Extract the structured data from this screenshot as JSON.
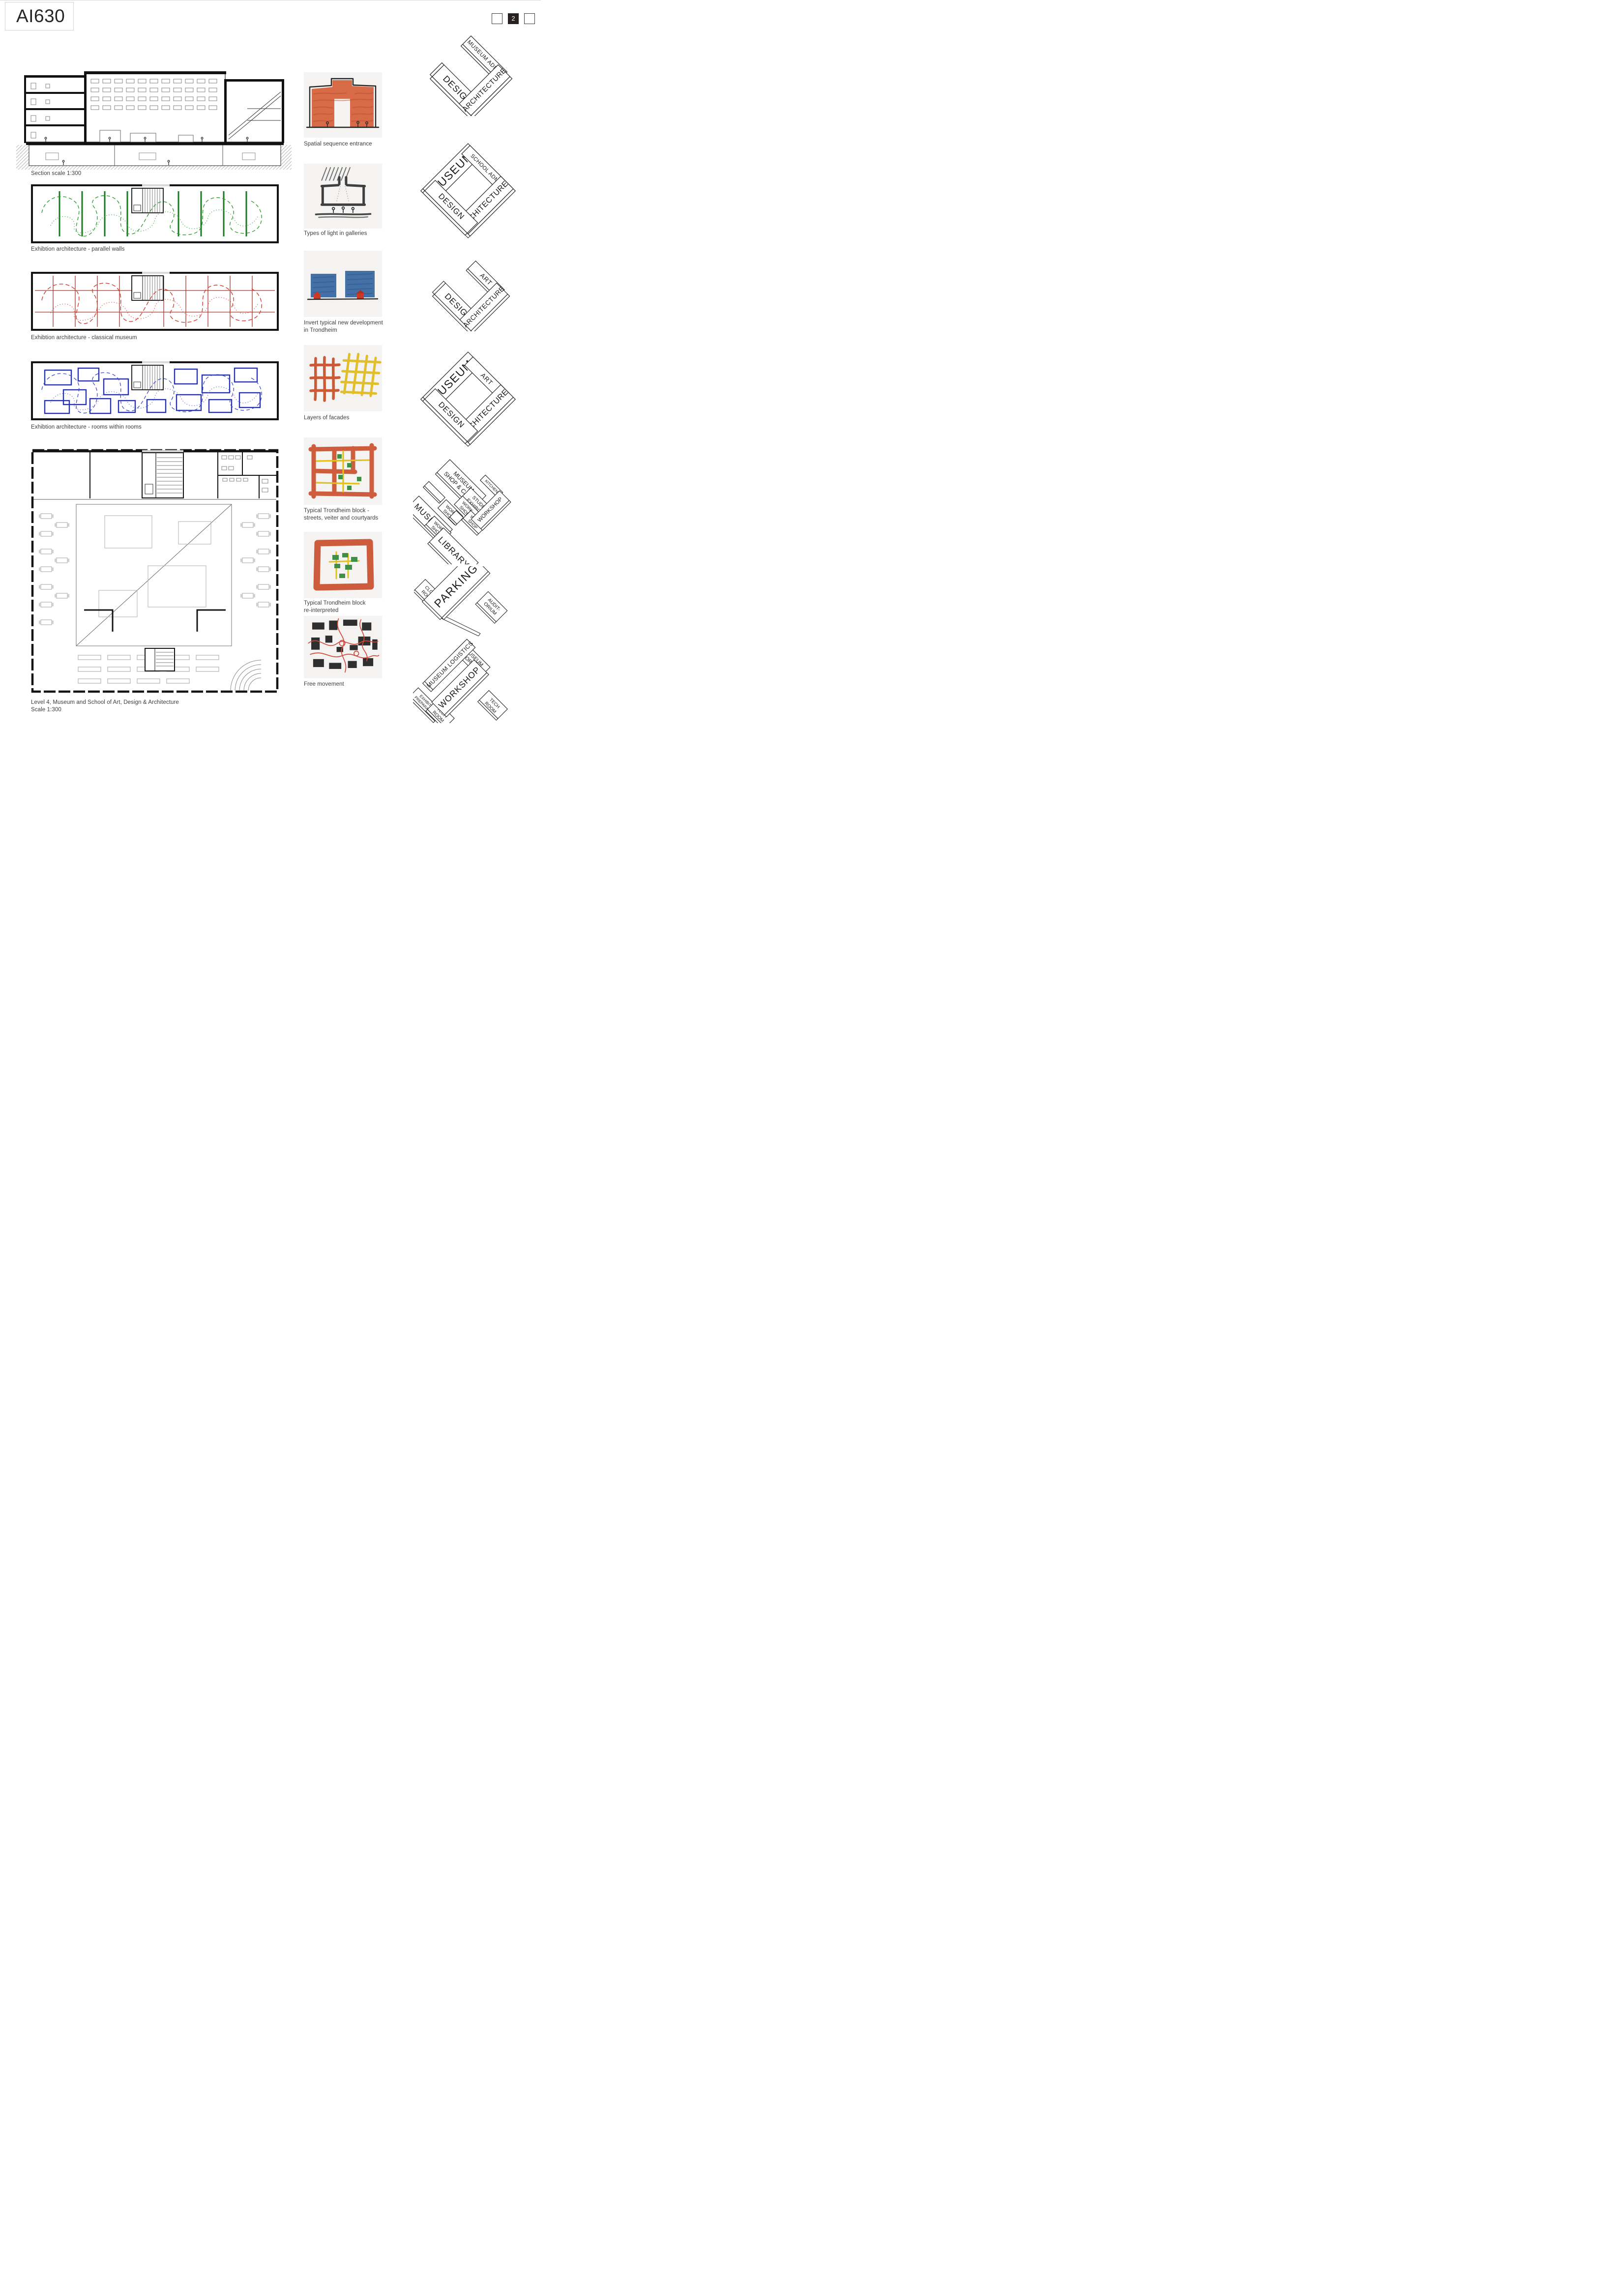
{
  "page": {
    "title": "AI630",
    "pager": {
      "prev_label": "",
      "current_label": "2",
      "next_label": ""
    }
  },
  "left_column": {
    "section_caption": "Section scale 1:300",
    "plan1_caption": "Exhibtion architecture - parallel walls",
    "plan2_caption": "Exhibtion architecture - classical museum",
    "plan3_caption": "Exhibtion architecture - rooms within rooms",
    "plan4_caption_line1": "Level 4, Museum and School of Art, Design & Architecture",
    "plan4_caption_line2": "Scale 1:300"
  },
  "middle_column": {
    "sketch1_caption": "Spatial sequence entrance",
    "sketch2_caption": "Types of light in galleries",
    "sketch3_caption_line1": "Invert typical new development",
    "sketch3_caption_line2": "in Trondheim",
    "sketch4_caption": "Layers of facades",
    "sketch5_caption_line1": "Typical Trondheim block -",
    "sketch5_caption_line2": "streets, veiter and courtyards",
    "sketch6_caption_line1": "Typical Trondheim block",
    "sketch6_caption_line2": "re-interpreted",
    "sketch7_caption": "Free movement"
  },
  "right_column": {
    "diagram1": {
      "admin": "MUSEUM ADMIN",
      "architecture": "ARCHITECTURE",
      "design": "DESIGN"
    },
    "diagram2": {
      "museum": "MUSEUM",
      "school_admin": "SCHOOL ADMIN",
      "architecture": "ARCHITECTURE",
      "design": "DESIGN"
    },
    "diagram3": {
      "art": "ART",
      "architecture": "ARCHITECTURE",
      "design": "DESIGN"
    },
    "diagram4": {
      "museum": "MUSEUM",
      "art": "ART",
      "architecture": "ARCHITECTURE",
      "design": "DESIGN"
    },
    "diagram5": {
      "shop_cafe_line1": "MUSEUM",
      "shop_cafe_line2": "SHOP & CAFÉ",
      "kitchen": "KITCHEN",
      "student_line1": "STUDENT",
      "student_line2": "EXHIBITION",
      "museum": "MUSEUM",
      "workshop_a_line1": "WORK-",
      "workshop_a_line2": "SHOP",
      "workshop_b_line1": "WORK-",
      "workshop_b_line2": "SHOP",
      "workshop_c_line1": "WORK-",
      "workshop_c_line2": "SHOP",
      "workshop_d_line1": "WORK-",
      "workshop_d_line2": "SHOP",
      "workshop_big": "WORKSHOP",
      "library": "LIBRARY"
    },
    "diagram6": {
      "cloak_line1": "CLOAK",
      "cloak_line2": "ROOM",
      "parking": "PARKING",
      "auditorium_line1": "AUDIT-",
      "auditorium_line2": "ORIUM"
    },
    "diagram7": {
      "storage_line1": "MUSEUM",
      "storage_line2": "STORAGE",
      "logistics": "MUSEUM LOGISTICS",
      "prep_line1": "EXHIBITION",
      "prep_line2": "PREPARATION",
      "tech_left_line1": "TECH",
      "tech_left_line2": "ROOM",
      "workshop": "WORKSHOP",
      "tech_right_line1": "TECH",
      "tech_right_line2": "ROOM"
    }
  },
  "colors": {
    "plan_green": "#1a7a1e",
    "plan_red": "#a8342a",
    "plan_blue": "#2834ad",
    "crayon_orange": "#cb5634",
    "crayon_yellow": "#e2c01f",
    "crayon_green": "#3f8f47",
    "crayon_blue": "#4470a8",
    "crayon_red": "#c83a28",
    "pager_active_bg": "#26211f"
  }
}
